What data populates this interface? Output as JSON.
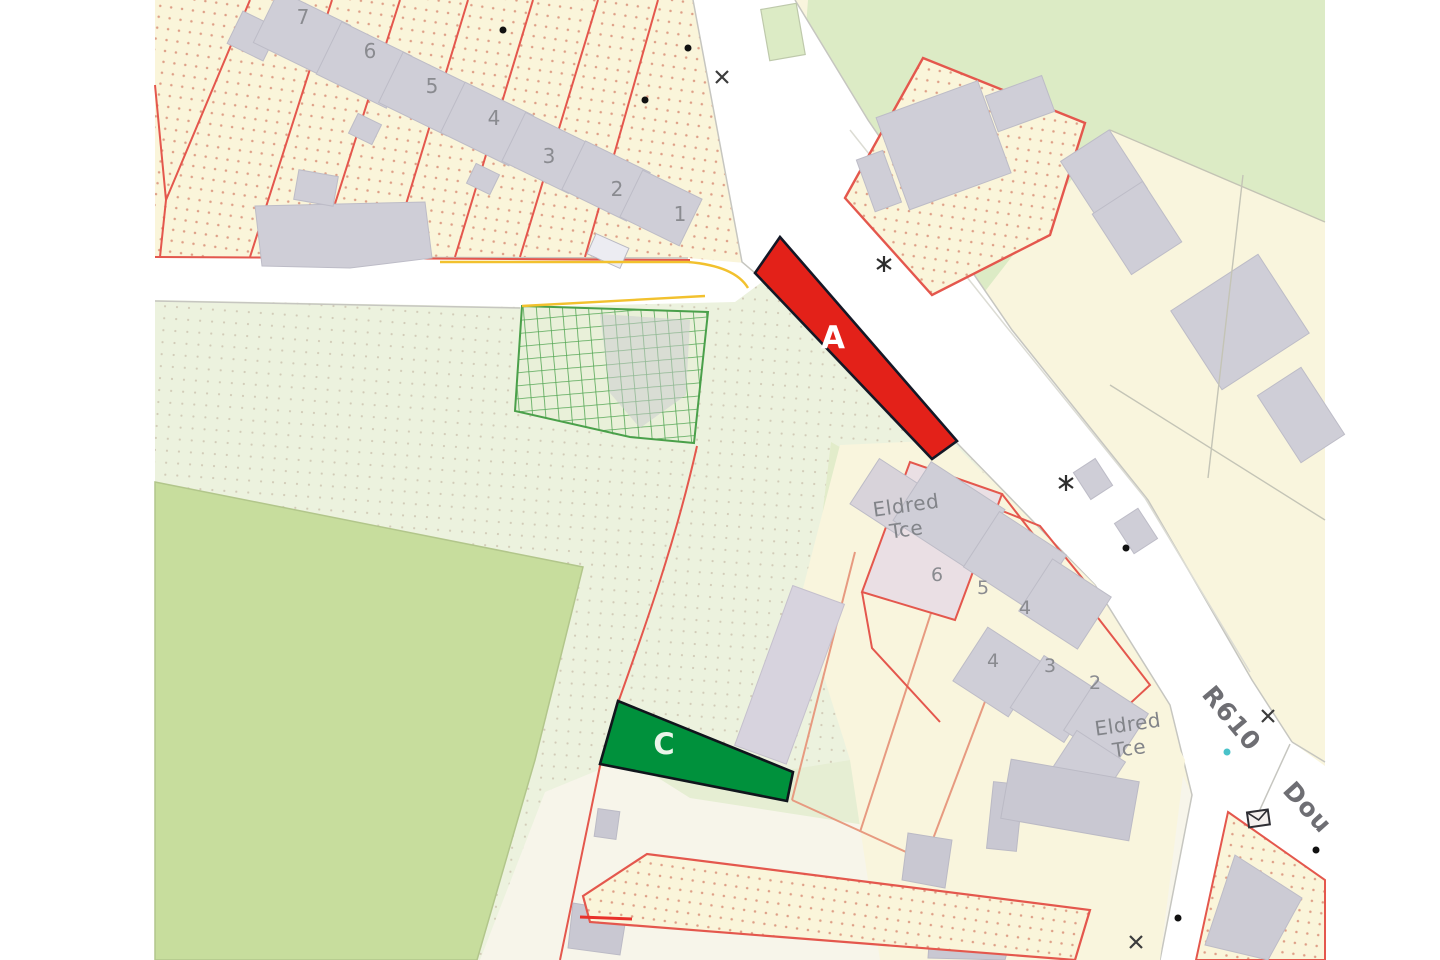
{
  "map": {
    "marker_a": "A",
    "marker_c": "C",
    "road_r610": "R610",
    "road_douglas_partial": "Dou",
    "terrace_upper": {
      "line1": "Eldred",
      "line2": "Tce"
    },
    "terrace_lower": {
      "line1": "Eldred",
      "line2": "Tce"
    },
    "north_numbers": [
      "7",
      "6",
      "5",
      "4",
      "3",
      "2",
      "1"
    ],
    "eldred_numbers": [
      "6",
      "5",
      "4",
      "4",
      "3",
      "2"
    ],
    "colors": {
      "plot_a_fill": "#e32119",
      "plot_c_fill": "#00913c",
      "overlay_outline": "#141826",
      "boundary_red": "#e4574d",
      "garden_orange": "#e79a80",
      "hatch_green": "#57a857",
      "cream": "#f9f5dd",
      "field_green": "#c7dd9d",
      "pale_green_dotted": "#ecf2de",
      "smooth_green": "#dcebc5",
      "building_grey": "#cfced7",
      "label_grey": "#8a8b90",
      "road_label_grey": "#6e6e73",
      "yellow_line": "#f2c12e",
      "teal_dot": "#49c2c9",
      "white_margin": "#ffffff"
    }
  }
}
